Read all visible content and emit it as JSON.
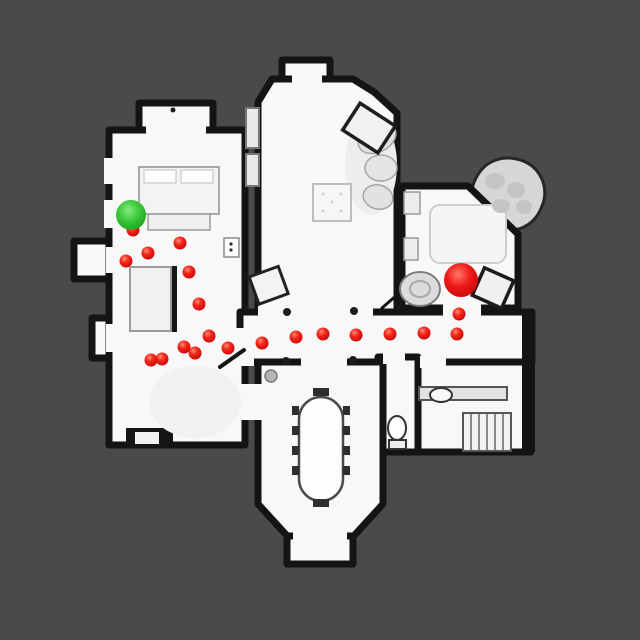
{
  "scene": {
    "kind": "indoor-topdown-navigation-map",
    "background_color": "#4a4a4a",
    "floor_color": "#f8f8f8",
    "wall_color": "#141414",
    "furniture_color": "#e9e9e9"
  },
  "markers": {
    "start": {
      "name": "start-marker",
      "x": 131,
      "y": 215,
      "radius": 15,
      "color": "#2fc42f"
    },
    "goal": {
      "name": "goal-marker",
      "x": 461,
      "y": 280,
      "radius": 17,
      "color": "#e81010"
    },
    "waypoint_radius": 6.5,
    "waypoint_color": "#e81010",
    "waypoints": [
      [
        133,
        230
      ],
      [
        126,
        261
      ],
      [
        148,
        253
      ],
      [
        180,
        243
      ],
      [
        189,
        272
      ],
      [
        199,
        304
      ],
      [
        209,
        336
      ],
      [
        184,
        347
      ],
      [
        195,
        353
      ],
      [
        162,
        359
      ],
      [
        151,
        360
      ],
      [
        228,
        348
      ],
      [
        262,
        343
      ],
      [
        296,
        337
      ],
      [
        323,
        334
      ],
      [
        356,
        335
      ],
      [
        390,
        334
      ],
      [
        424,
        333
      ],
      [
        457,
        334
      ],
      [
        459,
        314
      ]
    ],
    "wall_posts": [
      [
        287,
        312
      ],
      [
        354,
        311
      ],
      [
        286,
        361
      ],
      [
        353,
        360
      ]
    ],
    "door_stop_dot": [
      271,
      376
    ],
    "small_dot": [
      173,
      110
    ]
  }
}
